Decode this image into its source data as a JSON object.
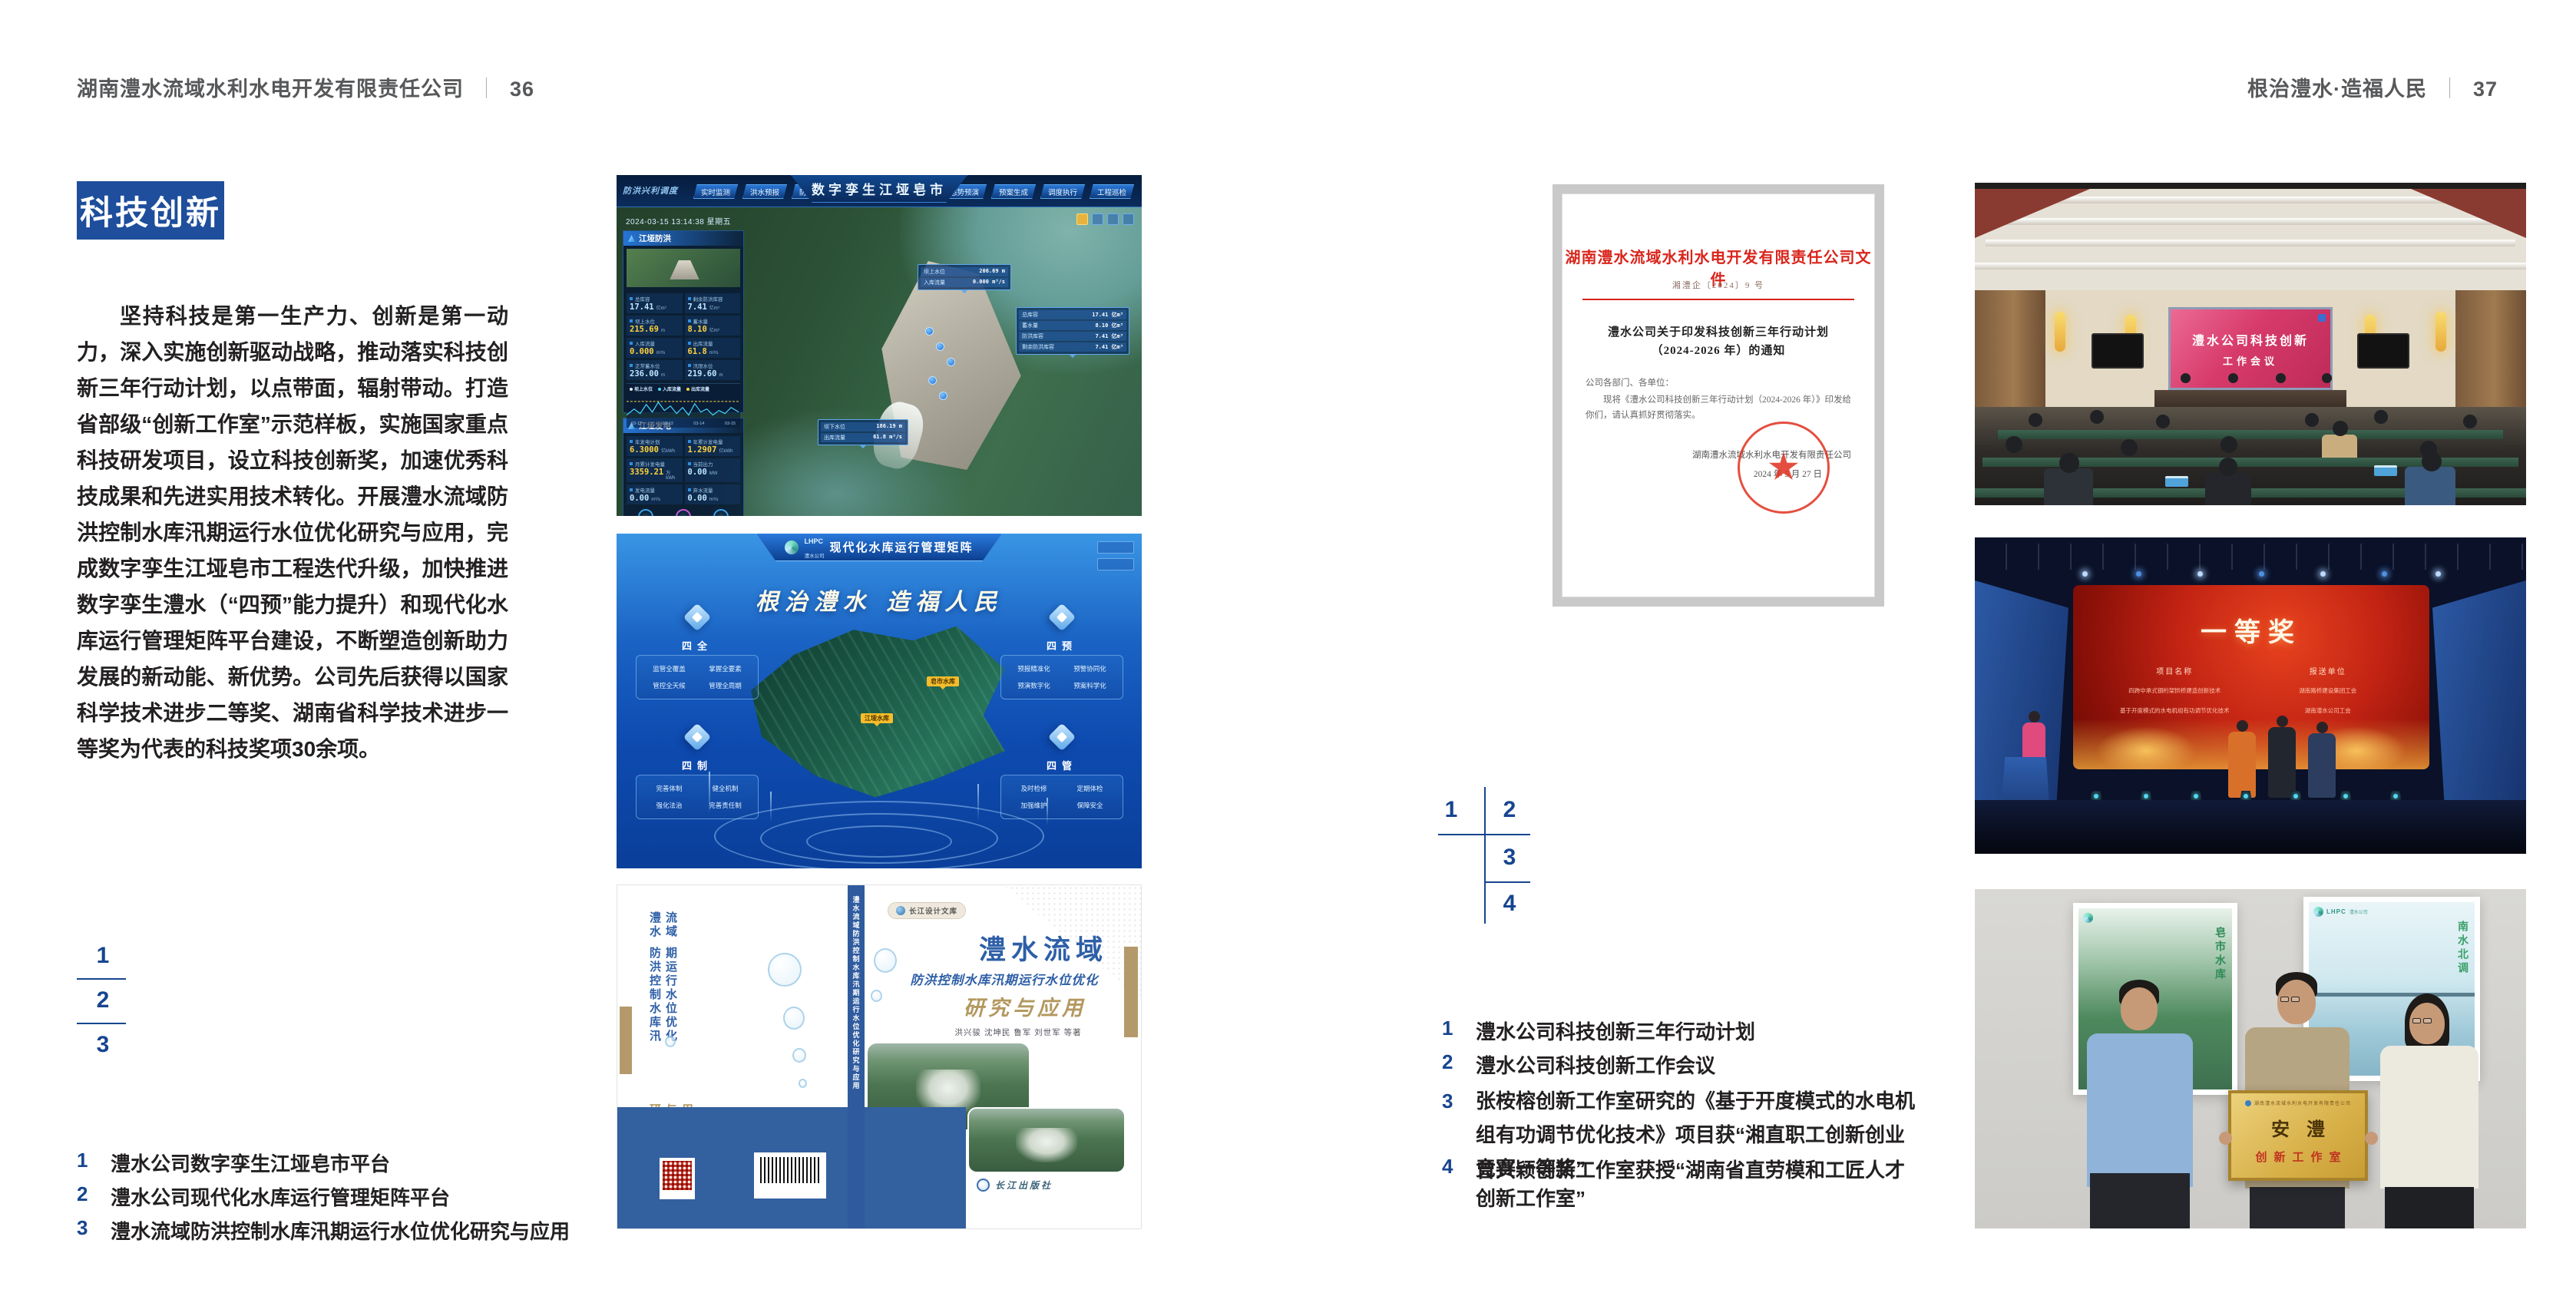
{
  "colors": {
    "accent_blue": "#1e4e9c",
    "index_blue": "#17458f",
    "doc_red": "#d9251c",
    "cover_blue": "#33609f",
    "cover_tan": "#b49a6a"
  },
  "page_left": {
    "header_title": "湖南澧水流域水利水电开发有限责任公司",
    "header_sep": "｜",
    "header_page": "36",
    "badge": "科技创新",
    "paragraph": "坚持科技是第一生产力、创新是第一动力，深入实施创新驱动战略，推动落实科技创新三年行动计划，以点带面，辐射带动。打造省部级“创新工作室”示范样板，实施国家重点科技研发项目，设立科技创新奖，加速优秀科技成果和先进实用技术转化。开展澧水流域防洪控制水库汛期运行水位优化研究与应用，完成数字孪生江垭皂市工程迭代升级，加快推进数字孪生澧水（“四预”能力提升）和现代化水库运行管理矩阵平台建设，不断塑造创新助力发展的新动能、新优势。公司先后获得以国家科学技术进步二等奖、湖南省科学技术进步一等奖为代表的科技奖项30余项。",
    "index_nums": [
      "1",
      "2",
      "3"
    ],
    "captions": [
      {
        "n": "1",
        "t": "澧水公司数字孪生江垭皂市平台"
      },
      {
        "n": "2",
        "t": "澧水公司现代化水库运行管理矩阵平台"
      },
      {
        "n": "3",
        "t": "澧水流域防洪控制水库汛期运行水位优化研究与应用"
      }
    ]
  },
  "page_right": {
    "header_title": "根治澧水·造福人民",
    "header_sep": "｜",
    "header_page": "37",
    "index_nums": [
      "1",
      "2",
      "3",
      "4"
    ],
    "captions": [
      {
        "n": "1",
        "t": "澧水公司科技创新三年行动计划"
      },
      {
        "n": "2",
        "t": "澧水公司科技创新工作会议"
      },
      {
        "n": "3",
        "t": "张桉榕创新工作室研究的《基于开度模式的水电机组有功调节优化技术》项目获“湘直职工创新创业竞赛一等奖”"
      },
      {
        "n": "4",
        "t": "曾兴颖创新工作室获授“湖南省直劳模和工匠人才创新工作室”"
      }
    ]
  },
  "dash1": {
    "corner_label": "防洪兴利调度",
    "title": "数字孪生江垭皂市",
    "tabs_left": [
      "实时监测",
      "洪水预报",
      "防洪预警"
    ],
    "tabs_right": [
      "态势预演",
      "预案生成",
      "调度执行",
      "工程巡检"
    ],
    "datetime": "2024-03-15 13:14:38 星期五",
    "panel_flood": {
      "title": "江垭防洪",
      "stats": [
        {
          "l": "总库容",
          "v": "17.41",
          "u": "亿m³"
        },
        {
          "l": "剩余防洪库容",
          "v": "7.41",
          "u": "亿m³"
        },
        {
          "l": "坝上水位",
          "v": "215.69",
          "u": "m"
        },
        {
          "l": "蓄水量",
          "v": "8.10",
          "u": "亿m³"
        },
        {
          "l": "入库流量",
          "v": "0.000",
          "u": "m³/s"
        },
        {
          "l": "出库流量",
          "v": "61.8",
          "u": "m³/s"
        },
        {
          "l": "正常蓄水位",
          "v": "236.00",
          "u": "m"
        },
        {
          "l": "汛限水位",
          "v": "219.60",
          "u": "m"
        }
      ],
      "legend": [
        "坝上水位",
        "入库流量",
        "出库流量"
      ],
      "x_labels": [
        "03-12",
        "03-13",
        "03-14",
        "03-15"
      ]
    },
    "panel_power": {
      "title": "江垭发电",
      "stats": [
        {
          "l": "年发电计划",
          "v": "6.3000",
          "u": "亿kWh"
        },
        {
          "l": "年累计发电量",
          "v": "1.2907",
          "u": "亿kWh"
        },
        {
          "l": "月累计发电量",
          "v": "3359.21",
          "u": "万kWh"
        },
        {
          "l": "当前出力",
          "v": "0.00",
          "u": "MW"
        },
        {
          "l": "发电流量",
          "v": "0.00",
          "u": "m³/s"
        },
        {
          "l": "弃水流量",
          "v": "0.00",
          "u": "m³/s"
        }
      ]
    },
    "callout_up": {
      "rows": [
        {
          "l": "坝上水位",
          "v": "206.69 m"
        },
        {
          "l": "入库流量",
          "v": "0.000 m³/s"
        }
      ]
    },
    "callout_mid": {
      "rows": [
        {
          "l": "总库容",
          "v": "17.41 亿m³"
        },
        {
          "l": "蓄水量",
          "v": "8.10 亿m³"
        },
        {
          "l": "防洪库容",
          "v": "7.41 亿m³"
        },
        {
          "l": "剩余防洪库容",
          "v": "7.41 亿m³"
        }
      ]
    },
    "callout_down": {
      "rows": [
        {
          "l": "坝下水位",
          "v": "186.19 m"
        },
        {
          "l": "出库流量",
          "v": "61.8 m³/s"
        }
      ]
    }
  },
  "dash2": {
    "logo_abbr": "LHPC",
    "logo_name": "澧水公司",
    "title": "现代化水库运行管理矩阵",
    "slogan": "根治澧水 造福人民",
    "panels": [
      {
        "title": "四全",
        "items": [
          "监管全覆盖",
          "掌握全要素",
          "管控全天候",
          "管理全周期"
        ]
      },
      {
        "title": "四制",
        "items": [
          "完善体制",
          "健全机制",
          "强化法治",
          "完善责任制"
        ]
      },
      {
        "title": "四预",
        "items": [
          "预报精准化",
          "预警协同化",
          "预演数字化",
          "预案科学化"
        ]
      },
      {
        "title": "四管",
        "items": [
          "及时检修",
          "定期体检",
          "加强维护",
          "保障安全"
        ]
      }
    ],
    "map_labels": [
      "江垭水库",
      "皂市水库"
    ]
  },
  "book": {
    "series": "长江设计文库",
    "title": "澧水流域",
    "subtitle": "防洪控制水库汛期运行水位优化",
    "title2": "研究与应用",
    "authors": "洪兴骏 沈坤民 鲁军 刘世军 等著",
    "publisher": "长江出版社",
    "spine": "澧水流域防洪控制水库汛期运行水位优化研究与应用",
    "back_line1": "澧水流域",
    "back_line2": "防洪控制水库汛期运行水位优化",
    "back_line3": "研究与应用"
  },
  "doc": {
    "header": "湖南澧水流域水利水电开发有限责任公司文件",
    "doc_no": "湘澧企〔2024〕9 号",
    "title1": "澧水公司关于印发科技创新三年行动计划",
    "title2": "（2024-2026 年）的通知",
    "salutation": "公司各部门、各单位：",
    "body": "现将《澧水公司科技创新三年行动计划（2024-2026 年）》印发给你们，请认真抓好贯彻落实。",
    "signer": "湖南澧水流域水利水电开发有限责任公司",
    "date": "2024 年 5 月 27 日",
    "seal_star": "★"
  },
  "meeting": {
    "screen1": "澧水公司科技创新",
    "screen2": "工作会议"
  },
  "award": {
    "title": "一等奖",
    "col1": "项目名称",
    "col2": "报送单位",
    "rows": [
      {
        "p": "四跨中承式钢桁架拱桥建造创新技术",
        "u": "湖南路桥建设集团工会"
      },
      {
        "p": "基于开度模式的水电机组有功调节优化技术",
        "u": "湖南澧水公司工会"
      }
    ]
  },
  "plaque": {
    "header": "湖南澧水流域水利水电开发有限责任公司",
    "name": "安澧",
    "sub": "创新工作室",
    "poster_left_label": "皂市水库",
    "poster_right_label": "南水北调",
    "poster_logo": "LHPC",
    "poster_logo_name": "澧水公司"
  }
}
